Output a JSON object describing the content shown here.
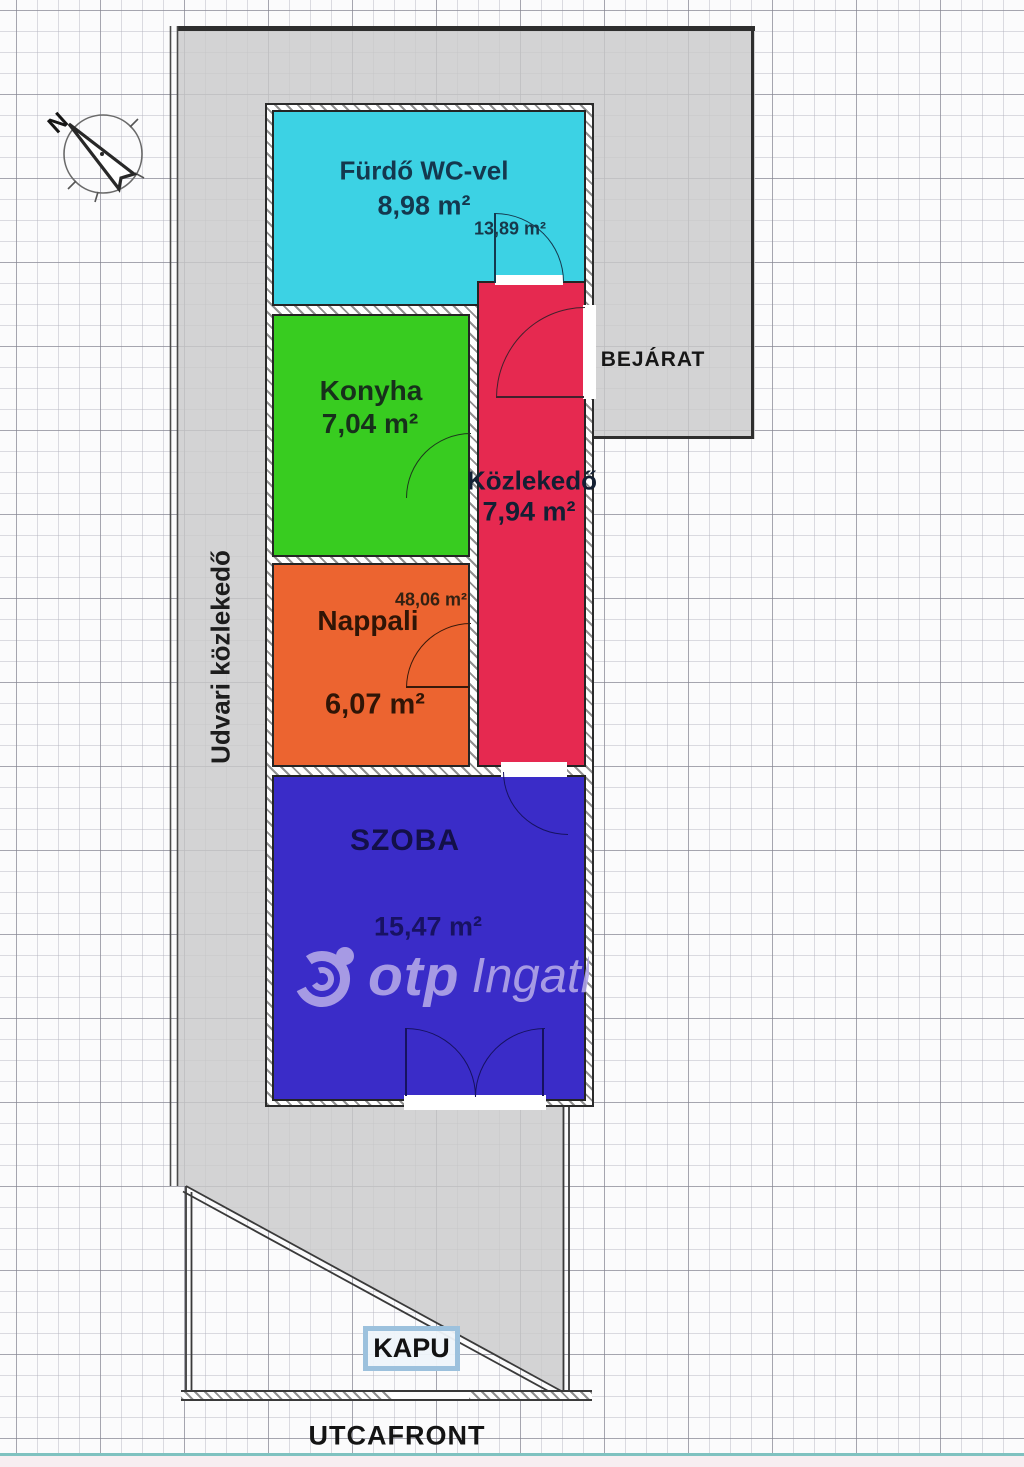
{
  "plan": {
    "labels": {
      "bejarat": "BEJÁRAT",
      "udvari_kozlekedo": "Udvari közlekedő",
      "kapu": "KAPU",
      "utcafront": "UTCAFRONT",
      "compass_letter": "N"
    },
    "rooms": [
      {
        "name": "Fürdő WC-vel",
        "area": "8,98 m²",
        "note": "13,89 m²",
        "color": "#3cd2e4"
      },
      {
        "name": "Konyha",
        "area": "7,04 m²",
        "color": "#38cc20"
      },
      {
        "name": "Közlekedő",
        "area": "7,94 m²",
        "color": "#e62950"
      },
      {
        "name": "Nappali",
        "area": "6,07 m²",
        "note": "48,06 m²",
        "color": "#ec6430"
      },
      {
        "name": "SZOBA",
        "area": "15,47 m²",
        "color": "#3a2cc8"
      }
    ],
    "watermark": {
      "brand": "otp",
      "suffix": "Ingatlan",
      "color": "#b2a7e8"
    },
    "colors": {
      "site_gray": "rgba(201,201,201,0.8)",
      "wall_dark": "#3a3a3a",
      "grid_major": "#8282 8e",
      "teal_baseline": "#7fc2c0",
      "kapu_border": "#9cc1dd"
    }
  }
}
